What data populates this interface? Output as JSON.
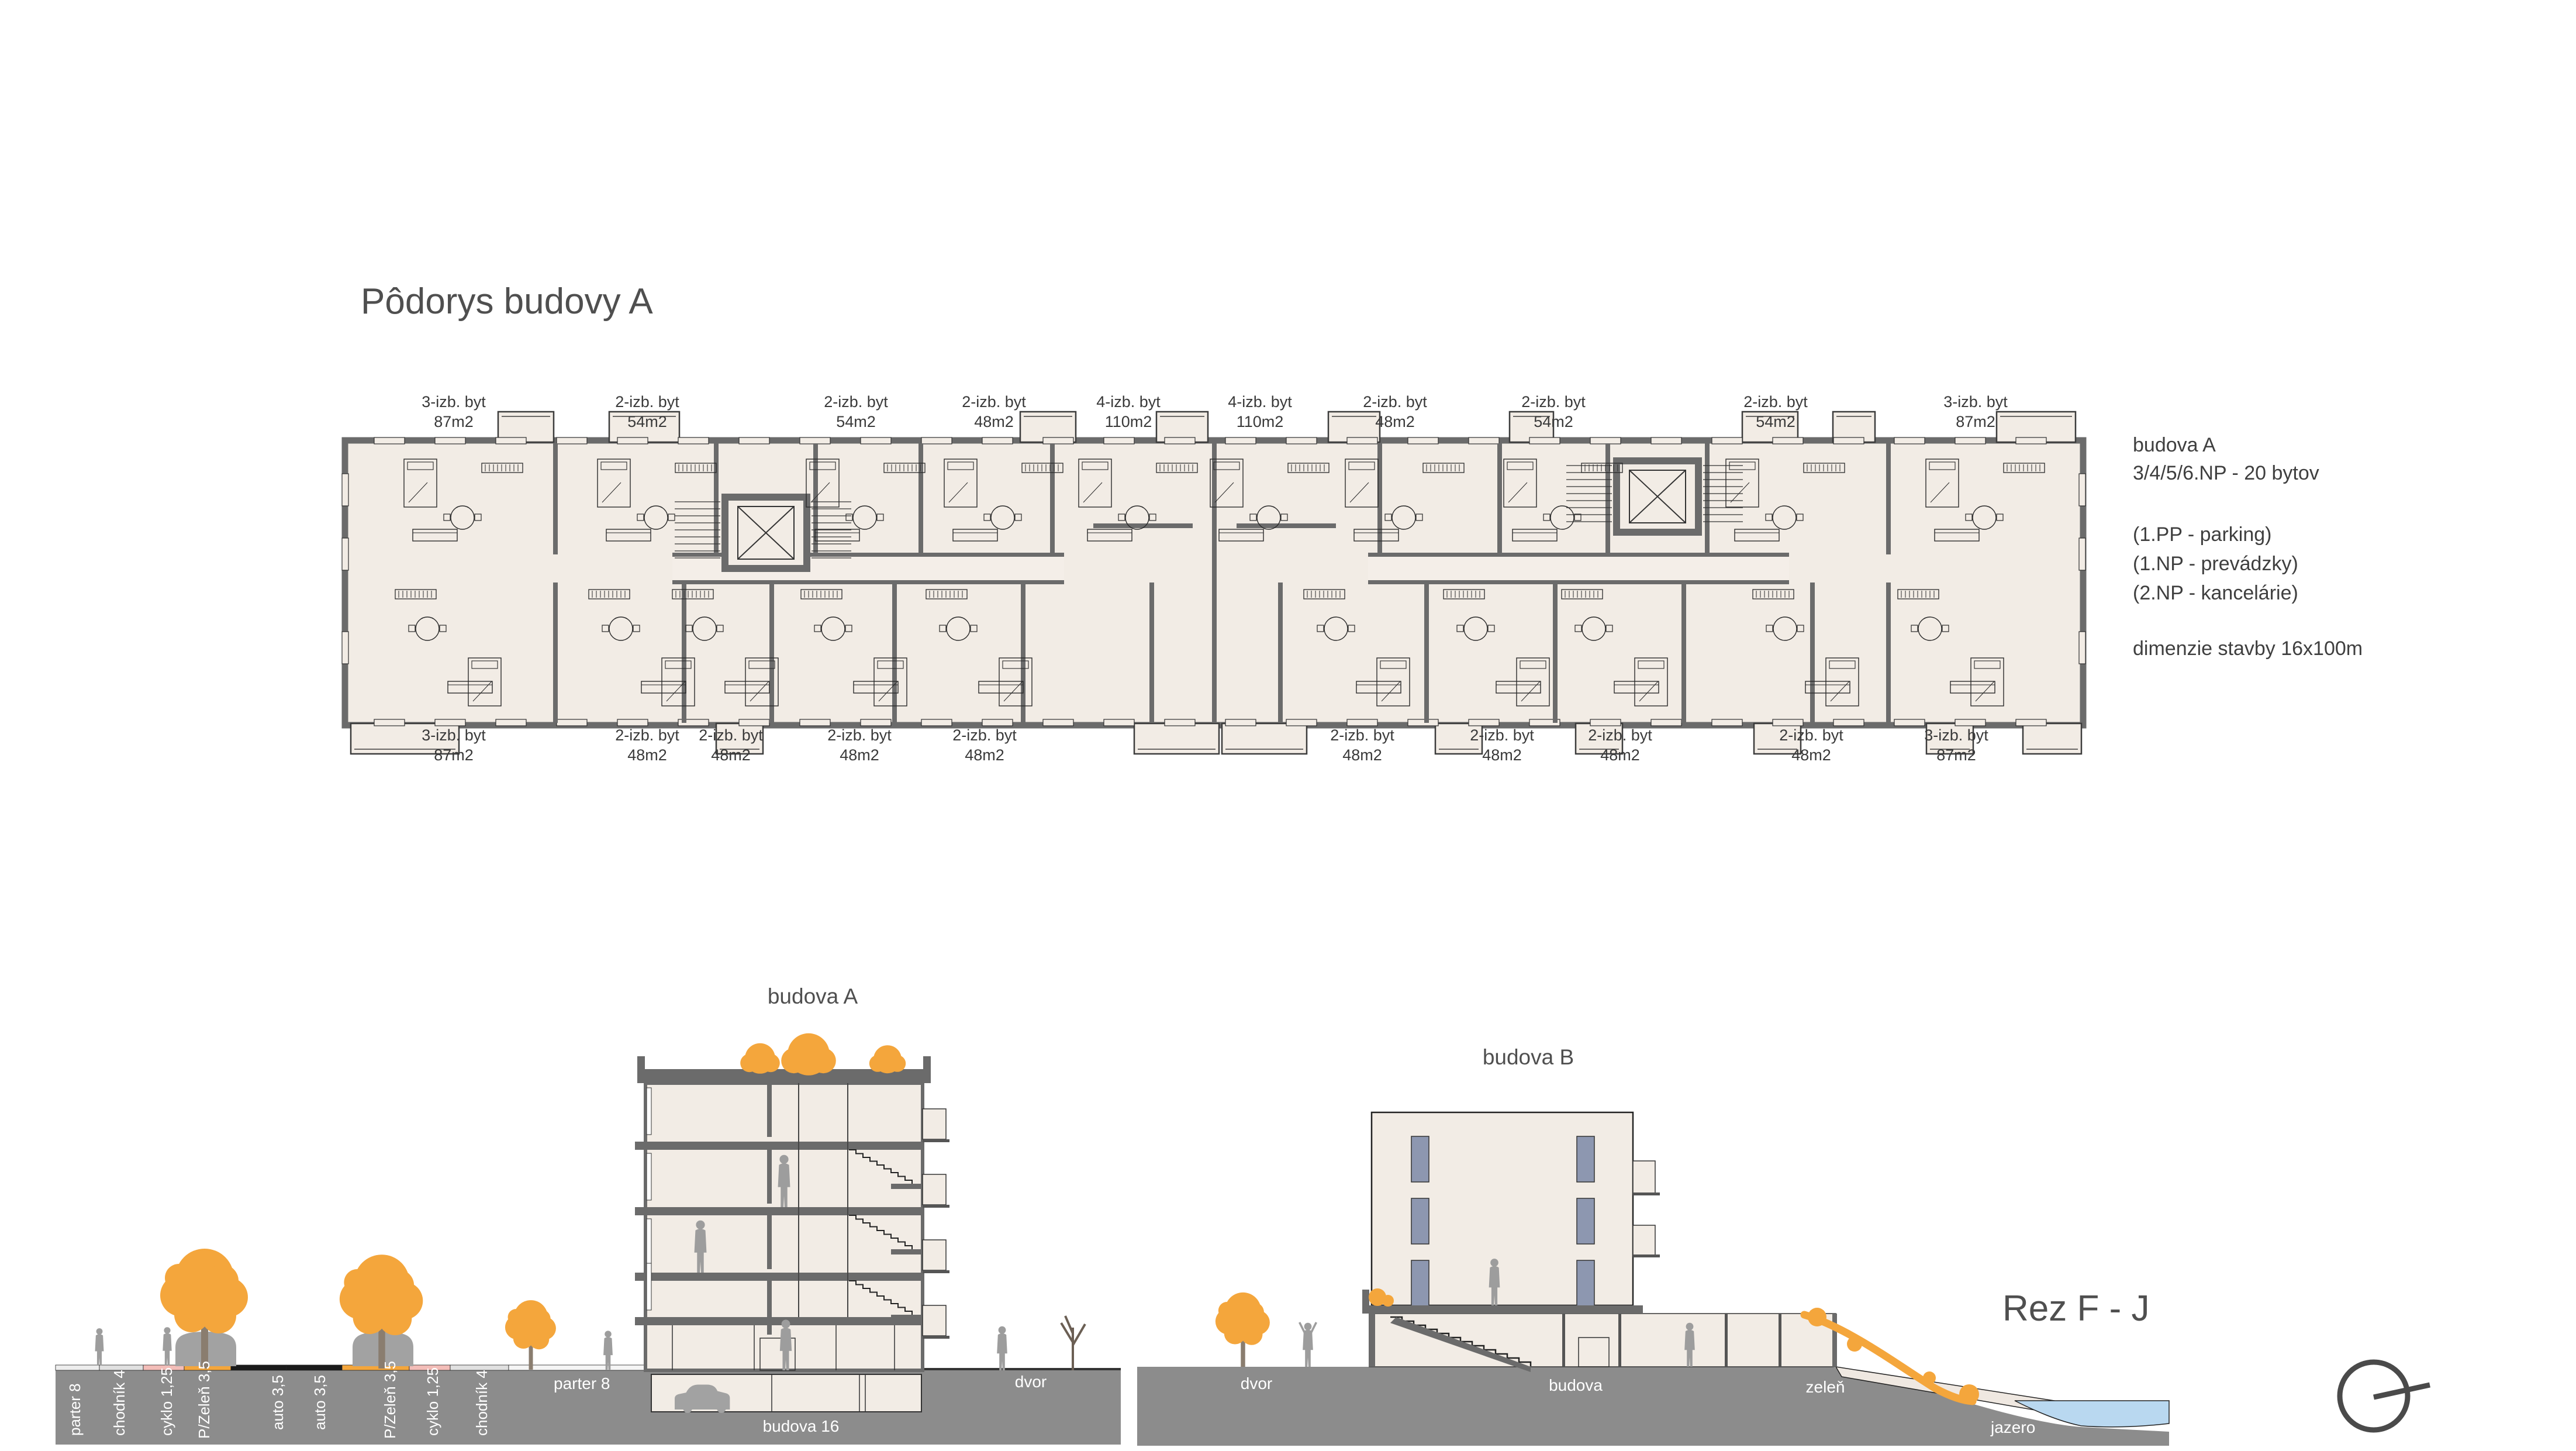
{
  "title": "Pôdorys budovy A",
  "annotations": {
    "building": "budova A",
    "floors": "3/4/5/6.NP - 20 bytov",
    "note_pp": "(1.PP - parking)",
    "note_np1": "(1.NP - prevádzky)",
    "note_np2": "(2.NP - kancelárie)",
    "dimensions": "dimenzie stavby 16x100m"
  },
  "plan": {
    "top_units": [
      {
        "type": "3-izb. byt",
        "area": "87m2"
      },
      {
        "type": "2-izb. byt",
        "area": "54m2"
      },
      {
        "type": "2-izb. byt",
        "area": "54m2"
      },
      {
        "type": "2-izb. byt",
        "area": "48m2"
      },
      {
        "type": "4-izb. byt",
        "area": "110m2"
      },
      {
        "type": "4-izb. byt",
        "area": "110m2"
      },
      {
        "type": "2-izb. byt",
        "area": "48m2"
      },
      {
        "type": "2-izb. byt",
        "area": "54m2"
      },
      {
        "type": "2-izb. byt",
        "area": "54m2"
      },
      {
        "type": "3-izb. byt",
        "area": "87m2"
      }
    ],
    "bottom_units": [
      {
        "type": "3-izb. byt",
        "area": "87m2"
      },
      {
        "type": "2-izb. byt",
        "area": "48m2"
      },
      {
        "type": "2-izb. byt",
        "area": "48m2"
      },
      {
        "type": "2-izb. byt",
        "area": "48m2"
      },
      {
        "type": "2-izb. byt",
        "area": "48m2"
      },
      {
        "type": "2-izb. byt",
        "area": "48m2"
      },
      {
        "type": "2-izb. byt",
        "area": "48m2"
      },
      {
        "type": "2-izb. byt",
        "area": "48m2"
      },
      {
        "type": "2-izb. byt",
        "area": "48m2"
      },
      {
        "type": "3-izb. byt",
        "area": "87m2"
      }
    ]
  },
  "section": {
    "title": "Rez F - J",
    "building_a_label": "budova A",
    "building_b_label": "budova B",
    "street_labels": [
      "parter 8",
      "chodník 4",
      "cyklo 1,25",
      "P/Zeleň 3,5",
      "auto 3,5",
      "auto 3,5",
      "P/Zeleň 3,5",
      "cyklo 1,25",
      "chodník 4"
    ],
    "parter_label": "parter 8",
    "garage_label": "budova 16",
    "dvor_a_label": "dvor",
    "dvor_b_label": "dvor",
    "budova_label": "budova",
    "zelen_label": "zeleň",
    "jazero_label": "jazero"
  },
  "colors": {
    "wall_gray": "#6b6b6b",
    "room_cream": "#f2ece5",
    "corridor_cream": "#f4eee8",
    "ground_gray": "#8c8c8c",
    "tree_orange": "#f4a63c",
    "water_blue": "#b9d8f0",
    "window_blue": "#8d97b0",
    "cyklo_pink": "#f3bdb8",
    "asphalt_black": "#1a1a1a",
    "figure_gray": "#9d9d9d",
    "text_dark": "#4a4a4a"
  }
}
